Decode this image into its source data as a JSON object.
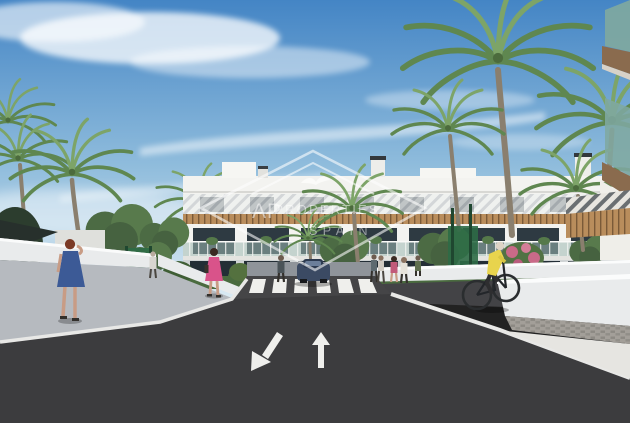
{
  "meta": {
    "title": "New-build apartment complex exterior render",
    "type": "architectural-visualization"
  },
  "watermark": {
    "monogram": "AP",
    "line1": "PROPERTIES",
    "line2": "SPAIN",
    "shape": "diamond-outline"
  },
  "colors": {
    "sky_top": "#4485c5",
    "sky_mid": "#8fbcdc",
    "sky_horizon": "#dcebf3",
    "cloud": "#ffffff",
    "building_wall": "#f3f3f0",
    "wood": "#b98d5c",
    "wood_dark": "#7a5a38",
    "window_glass": "#2e3a42",
    "balcony_glass": "#9db8b3",
    "asphalt": "#3c3c3e",
    "road_marking": "#efefec",
    "sidewalk": "#b6babf",
    "wall_white": "#e9ebec",
    "paver": "#a39f99",
    "hedge": "#4a6b3f",
    "palm_green": "#5f8750",
    "palm_trunk": "#8a7f6e",
    "fence_green": "#2e6b46",
    "car_body": "#3b4a63",
    "dress_blue": "#3c5a96",
    "top_pink": "#d9538a",
    "vest_yellow": "#e8d44d",
    "flower_pink": "#c96a88",
    "glass_teal": "#7fa8a0"
  },
  "scene": {
    "setting": "sunny day, blue sky with wispy clouds, palm trees",
    "building": "white 3-storey apartment block with wood louvres and glass balconies",
    "road": {
      "surface": "dark asphalt",
      "lane_arrows": [
        "down-left",
        "up"
      ],
      "crosswalk_stripes": 6
    },
    "figures": {
      "pedestrians": 8,
      "cyclist": 1,
      "parked_car": 1
    },
    "foreground_right": "close-up balcony corner with teal glass and timber soffits",
    "walls": "white retaining walls flanking the entrance road"
  }
}
